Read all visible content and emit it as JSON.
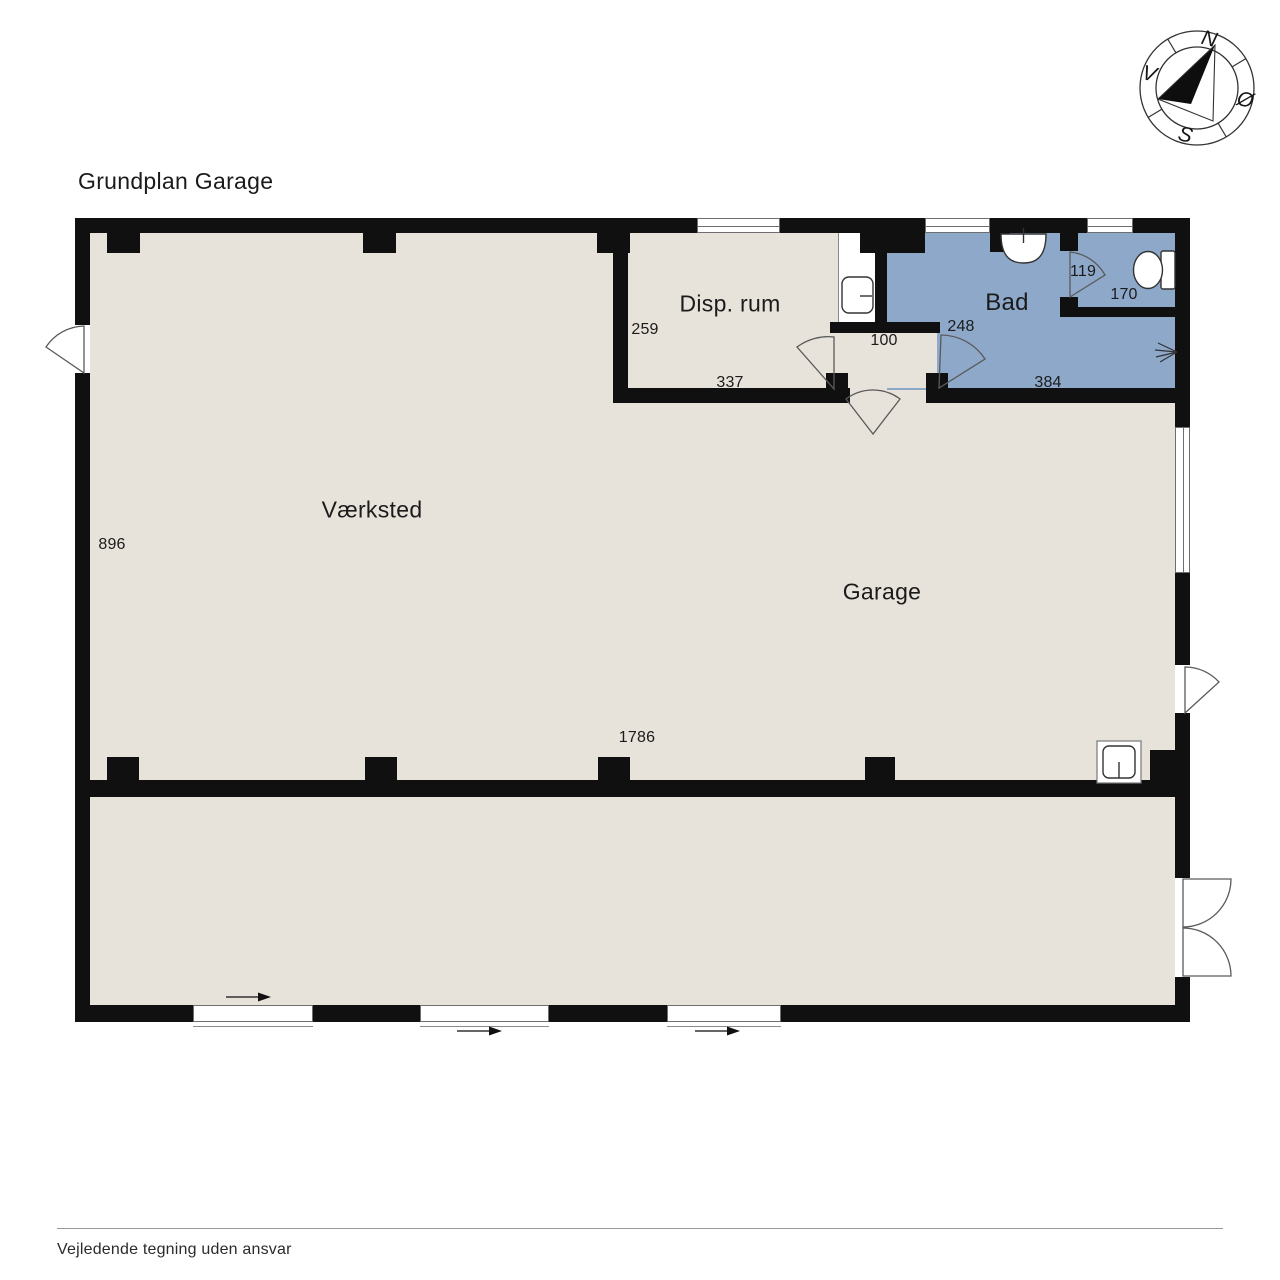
{
  "title": "Grundplan Garage",
  "compass": {
    "north": "N",
    "east": "Ø",
    "south": "S",
    "west": "V"
  },
  "rooms": {
    "vaerksted": "Værksted",
    "garage": "Garage",
    "disp_rum": "Disp. rum",
    "bad": "Bad"
  },
  "dims": {
    "d896": "896",
    "d1786": "1786",
    "d259": "259",
    "d337": "337",
    "d100": "100",
    "d248": "248",
    "d119": "119",
    "d170": "170",
    "d384": "384"
  },
  "footer": "Vejledende tegning uden ansvar",
  "colors": {
    "floor": "#e7e2da",
    "bath": "#8da8c9",
    "wall": "#101010"
  }
}
